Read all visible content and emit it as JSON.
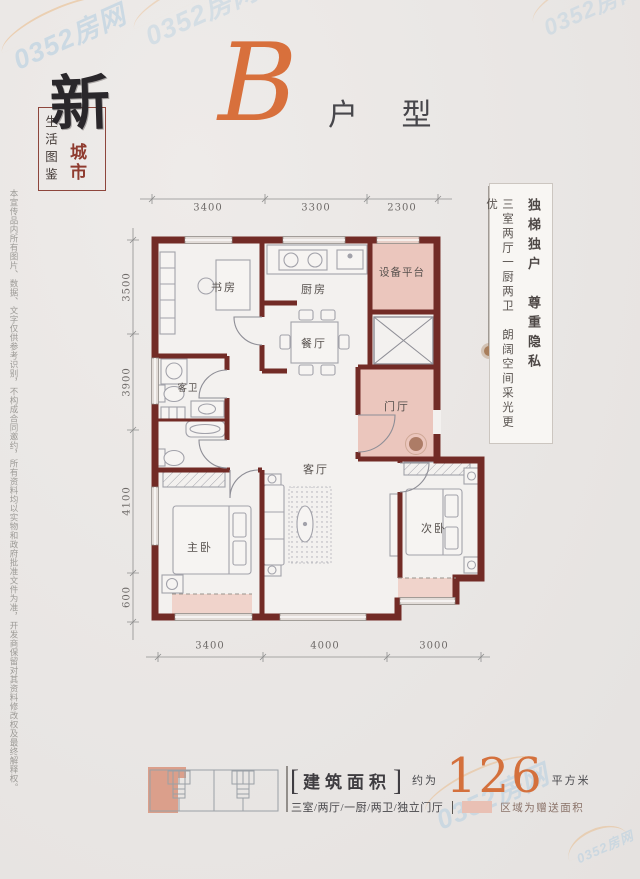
{
  "title": {
    "letter": "B",
    "suffix": "户 型"
  },
  "logo": {
    "calligraphy": "新",
    "city": "城市",
    "box_label": "生活图鉴"
  },
  "disclaimer": "本宣传品内所有图片、数据、文字仅供参考识别，不构成合同邀约，所有资料均以实物和政府批准文件为准，开发商保留对其资料修改权及最终解释权。",
  "callout": {
    "headline": "独梯独户　尊重隐私",
    "subline": "三室两厅一厨两卫　朗阔空间采光更优"
  },
  "floorplan": {
    "rooms": {
      "study": "书房",
      "kitchen": "厨房",
      "equipment": "设备平台",
      "dining": "餐厅",
      "guest_bath": "客卫",
      "foyer": "门厅",
      "living": "客厅",
      "master": "主卧",
      "secondary": "次卧"
    },
    "dims": {
      "top": [
        "3400",
        "3300",
        "2300"
      ],
      "left": [
        "3500",
        "3900",
        "4100",
        "600"
      ],
      "bottom": [
        "3400",
        "4000",
        "3000"
      ]
    }
  },
  "area": {
    "bracket_l": "[",
    "label": "建筑面积",
    "bracket_r": "]",
    "approx": "约为",
    "value": "126",
    "unit": "平方米",
    "layout": "三室/两厅/一厨/两卫/独立门厅",
    "legend_note": "区域为赠送面积"
  },
  "watermark": {
    "text": "0352房网"
  },
  "colors": {
    "wall": "#722b26",
    "accent_orange": "#d8703c",
    "highlight_pink": "#ebc6bd",
    "brand_red": "#8f3b2f"
  }
}
